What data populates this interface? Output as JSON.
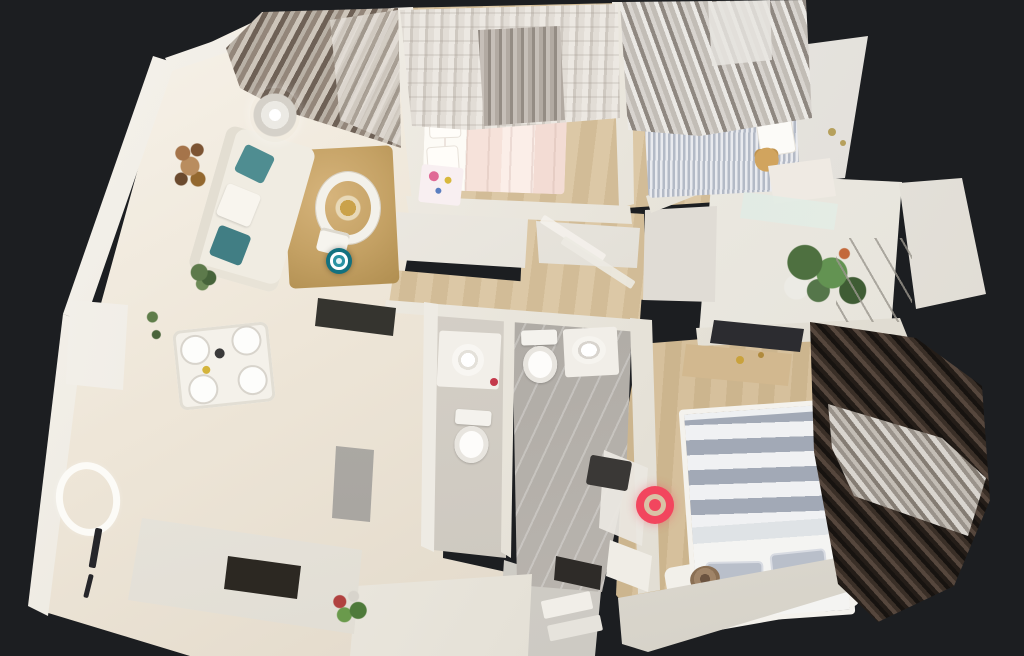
{
  "scene": {
    "app": "3D virtual tour viewer",
    "view": "dollhouse top-down view of a furnished apartment 3D scan",
    "background_color": "#1c1e21"
  },
  "markers": [
    {
      "name": "waypoint-marker",
      "room": "living-room",
      "shape": "ring-bullseye",
      "x": 339,
      "y": 261,
      "size": 26,
      "outer_color": "#12717f",
      "ring_color": "#ffffff",
      "inner_color": "#2a93a3",
      "center_color": "#e6f5f7"
    },
    {
      "name": "current-position-marker",
      "room": "master-bedroom",
      "shape": "bullseye",
      "x": 655,
      "y": 505,
      "size": 38,
      "outer_color": "#f2465e",
      "gap_color": "#d9c3a6",
      "center_color": "#f2465e"
    }
  ],
  "rooms": [
    {
      "id": "living-room",
      "features": [
        "white sofa with teal cushions",
        "tan shag rug",
        "round coffee table",
        "crystal chandelier",
        "circular wall art",
        "floor plant",
        "striped drapes"
      ]
    },
    {
      "id": "dining-area",
      "features": [
        "white dining table with four place settings",
        "sideboard shelf",
        "ceiling light ring"
      ]
    },
    {
      "id": "kitchen",
      "features": [
        "dark cooktop cabinet",
        "sink",
        "counter with oven niche",
        "flower arrangement"
      ]
    },
    {
      "id": "hallway",
      "features": [
        "wood floor",
        "open door panels"
      ]
    },
    {
      "id": "bedroom-small",
      "features": [
        "bed with white pillows and pale pink duvet",
        "patterned curtains",
        "pink nightstand with toys"
      ]
    },
    {
      "id": "bedroom-pinstripe",
      "features": [
        "pinstriped bed",
        "teddy bear",
        "silver striped curtains",
        "desk",
        "glass table"
      ]
    },
    {
      "id": "master-bedroom",
      "features": [
        "gray and white striped bed",
        "wall tv",
        "wood dresser",
        "dark brown curtains",
        "open door",
        "rolled blanket"
      ]
    },
    {
      "id": "bathroom-inner",
      "features": [
        "vanity with round basin",
        "toilet",
        "red accessory"
      ]
    },
    {
      "id": "bathroom-main",
      "features": [
        "toilet",
        "vanity with basin",
        "dark bath mat",
        "gray marble tile floor"
      ]
    },
    {
      "id": "balcony",
      "features": [
        "potted plants",
        "drying rack",
        "white privacy panel"
      ]
    },
    {
      "id": "entryway",
      "features": [
        "shoe cabinets",
        "dark floor mat"
      ]
    }
  ],
  "palette": {
    "background": "#1c1e21",
    "floor_cream": "#ece4d6",
    "floor_wood": "#d5c09c",
    "tile_gray": "#b8b4ae",
    "wall_white": "#f2efe9",
    "rug_tan": "#c4a164",
    "curtain_dark_brown": "#4a3c33",
    "curtain_silver": "#c6c1bb",
    "cushion_teal": "#4f8d91",
    "bed_stripe_gray": "#a2a9b6",
    "accent_teal": "#12717f",
    "accent_red": "#f2465e"
  }
}
